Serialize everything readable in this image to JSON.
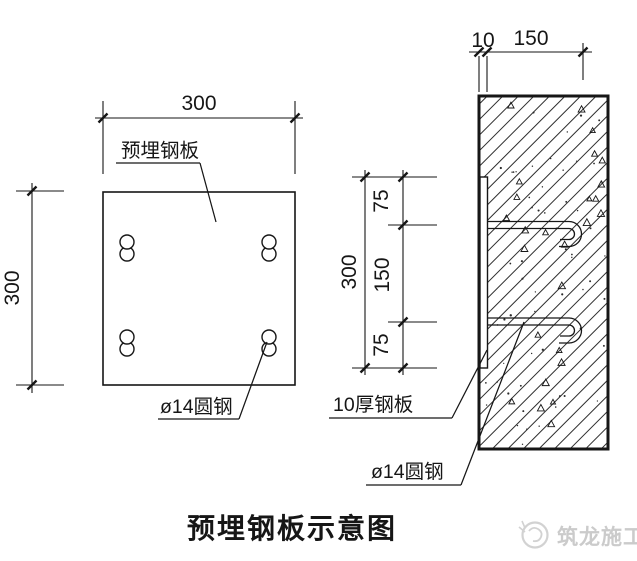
{
  "page": {
    "title": "预埋钢板示意图"
  },
  "plan_view": {
    "dim_width": "300",
    "dim_height": "300",
    "plate_label": "预埋钢板",
    "rod_label": "ø14圆钢"
  },
  "section_view": {
    "dim_plate_thickness": "10",
    "dim_anchor_length": "150",
    "dim_height": "300",
    "dim_top": "75",
    "dim_mid": "150",
    "dim_bottom": "75",
    "plate_label": "10厚钢板",
    "rod_label": "ø14圆钢"
  },
  "watermark": {
    "brand": "筑龙施工"
  },
  "colors": {
    "line": "#161616",
    "watermark": "#cbcbcb"
  }
}
